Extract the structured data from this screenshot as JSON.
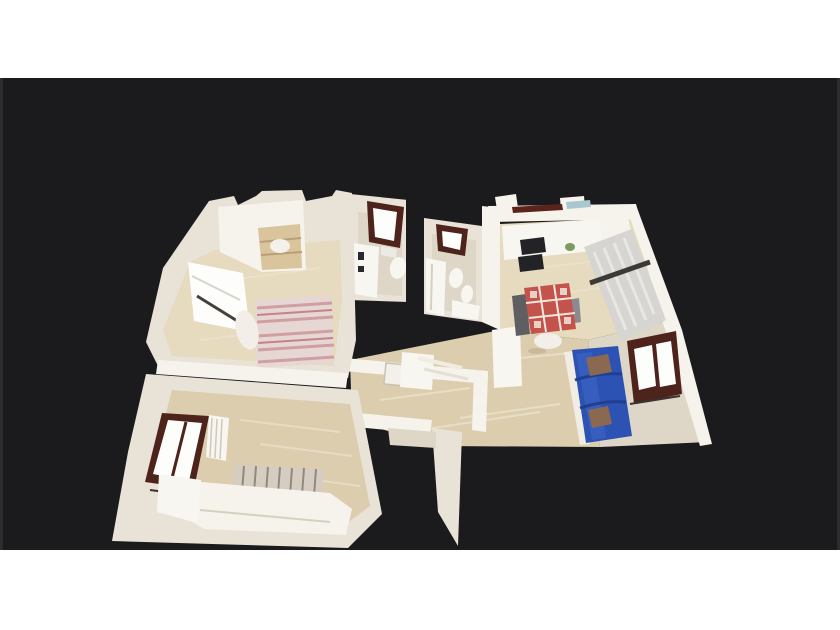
{
  "viewer": {
    "type": "3d-dollhouse-view",
    "aria_label": "Top-down 3D dollhouse scan of a furnished apartment on a dark canvas",
    "rooms": [
      {
        "id": "bedroom-1",
        "label": "Main bedroom with wardrobe, bright window and pink striped double bed"
      },
      {
        "id": "bathroom-1",
        "label": "Bathroom with dark framed window, vanity sink and toilet"
      },
      {
        "id": "bathroom-2",
        "label": "Second bathroom with window, bathtub, toilet, bidet and sink"
      },
      {
        "id": "kitchen",
        "label": "Kitchen and dining area with counters, cooktop, curtained window and red patchwork table"
      },
      {
        "id": "living-room",
        "label": "Living area with blue sofa, brown cushions and dark framed window"
      },
      {
        "id": "bedroom-2",
        "label": "Second room with dark framed window, radiator and striped daybed"
      },
      {
        "id": "hallway",
        "label": "Central hallway with wood floor, interior walls and door frames"
      }
    ]
  },
  "colors": {
    "page_bg": "#ffffff",
    "canvas_bg": "#1b1b1d",
    "canvas_edge": "#2d2d30",
    "wall": "#e9e2d7",
    "wall_bright": "#f6f3ec",
    "wall_shade": "#d7cfc0",
    "floor_wood": "#dccdae",
    "floor_wood_light": "#e6dabf",
    "floor_pale": "#ded7c8",
    "window_frame": "#4e231b",
    "glass": "#f3f1ec",
    "glass_bright": "#fdfdfb",
    "curtain": "#d6d5d1",
    "curtain_dark": "#3c3a36",
    "fixture_white": "#f8f6f0",
    "fixture_dark": "#232327",
    "bed_base": "#e7d7d4",
    "bed_stripe_pink": "#cf9fa2",
    "bed_stripe_red": "#c4838a",
    "stripe_beige": "#d6cdc2",
    "stripe_dark": "#948879",
    "sofa_blue": "#2c52b4",
    "sofa_blue_dark": "#20408f",
    "sofa_blue_light": "#4066c6",
    "pillow_brown": "#8b6850",
    "table_red": "#c4544b",
    "table_pattern": "#f0e7de",
    "chair_gray": "#5e5e63",
    "wood_shelf": "#d9c49c",
    "plant_green": "#7d9b5e",
    "accent_maroon": "#5c231c",
    "accent_teal": "#a9c7cf",
    "floor_streak": "#efe6d2"
  }
}
